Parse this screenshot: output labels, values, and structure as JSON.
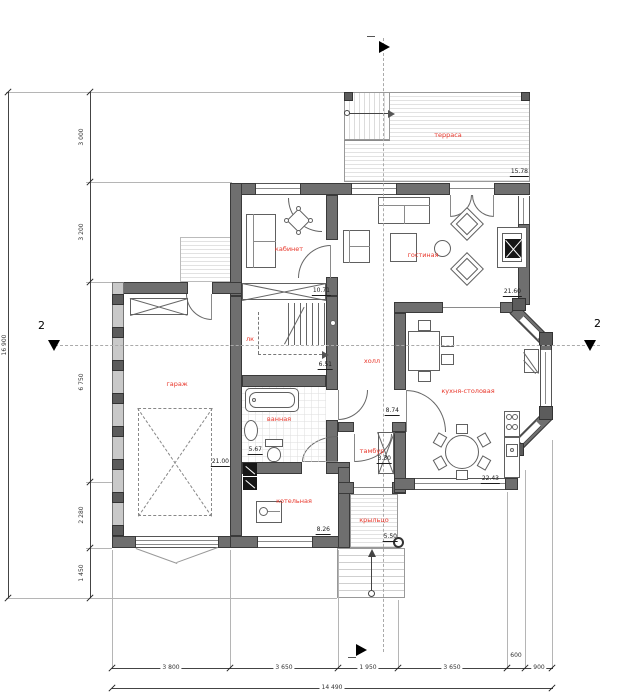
{
  "drawing": {
    "rooms": {
      "terrace": {
        "label": "терраса",
        "area": "15.78"
      },
      "study": {
        "label": "кабинет",
        "area": "10.71"
      },
      "living": {
        "label": "гостиная",
        "area": "21.60"
      },
      "stair": {
        "label": "лк",
        "area": "6.51"
      },
      "hall": {
        "label": "холл",
        "area": "8.74"
      },
      "garage": {
        "label": "гараж",
        "area": "21.00"
      },
      "bathroom": {
        "label": "ванная",
        "area": "5.67"
      },
      "boiler": {
        "label": "котельная",
        "area": "8.26"
      },
      "vestibule": {
        "label": "тамбур",
        "area": "3.30"
      },
      "kitchen": {
        "label": "кухня-столовая",
        "area": "22.43"
      },
      "porch": {
        "label": "крыльцо",
        "area": "5.50"
      }
    },
    "dims": {
      "left": {
        "segments": [
          "3 000",
          "3 200",
          "6 750",
          "2 280",
          "1 450"
        ],
        "total": "16 900"
      },
      "bottom": {
        "segments": [
          "3 800",
          "3 650",
          "1 950",
          "3 650",
          "600",
          "900"
        ],
        "total": "14 490"
      }
    },
    "sections": {
      "left": "2",
      "right": "2"
    },
    "colors": {
      "wall": "#6f6f6f",
      "room_label": "#e8372b",
      "dimension_text": "#333333"
    }
  }
}
